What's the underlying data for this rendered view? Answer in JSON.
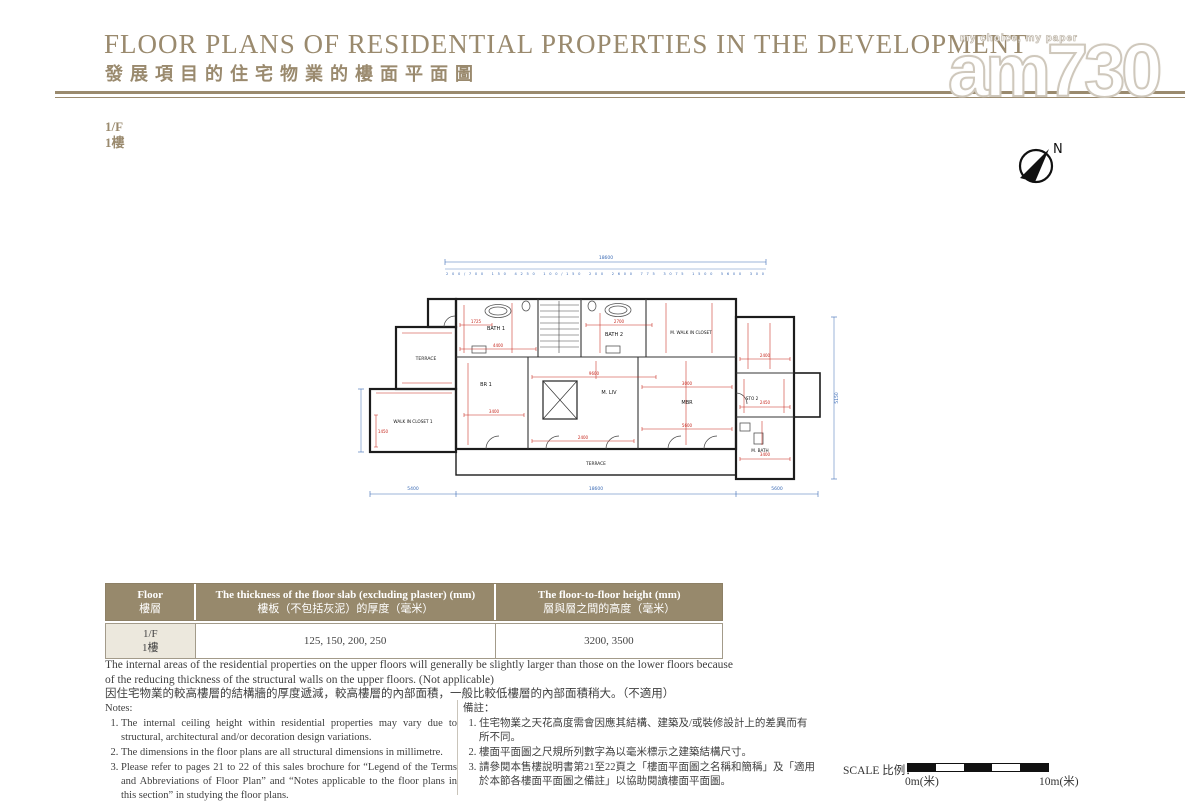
{
  "header": {
    "title_en": "FLOOR PLANS OF RESIDENTIAL PROPERTIES IN THE DEVELOPMENT",
    "title_zh": "發展項目的住宅物業的樓面平面圖"
  },
  "watermark": {
    "tagline": "my choice, my paper",
    "brand": "am730"
  },
  "floor_label": {
    "en": "1/F",
    "zh": "1樓"
  },
  "compass": {
    "n": "N"
  },
  "plan": {
    "rooms": [
      "BATH 1",
      "BATH 2",
      "M. WALK IN CLOSET",
      "TERRACE",
      "WALK IN CLOSET 1",
      "BR 1",
      "M. LIV",
      "MBR",
      "STO 2",
      "M. BATH",
      "TERRACE"
    ],
    "dims_blue": {
      "top_total": "18600",
      "top_subs": "200/700 150 4250 100/150 200 2600 775 3075 1500 5600 300",
      "bottom_left": "5400",
      "bottom_center": "18600",
      "bottom_right": "5600",
      "right_side": "5150"
    },
    "dims_red": [
      "4400",
      "9600",
      "3400",
      "3000",
      "2400",
      "2450",
      "5600",
      "2400",
      "1450",
      "3400",
      "1725",
      "2700"
    ]
  },
  "table": {
    "headers": {
      "floor_en": "Floor",
      "floor_zh": "樓層",
      "thickness_en": "The thickness of the floor slab (excluding plaster) (mm)",
      "thickness_zh": "樓板（不包括灰泥）的厚度（毫米）",
      "height_en": "The floor-to-floor height (mm)",
      "height_zh": "層與層之間的高度（毫米）"
    },
    "row": {
      "floor_en": "1/F",
      "floor_zh": "1樓",
      "thickness": "125, 150, 200, 250",
      "height": "3200, 3500"
    }
  },
  "area_note": {
    "en": "The internal areas of the residential properties on the upper floors will generally be slightly larger than those on the lower floors because of the reducing thickness of the structural walls on the upper floors. (Not applicable)",
    "zh": "因住宅物業的較高樓層的結構牆的厚度遞減，較高樓層的內部面積，一般比較低樓層的內部面積稍大。（不適用）"
  },
  "notes_en": {
    "title": "Notes:",
    "items": [
      "The internal ceiling height within residential properties may vary due to structural, architectural and/or decoration design variations.",
      "The dimensions in the floor plans are all structural dimensions in millimetre.",
      "Please refer to pages 21 to 22 of this sales brochure for “Legend of the Terms and Abbreviations of Floor Plan” and “Notes applicable to the floor plans in this section” in studying the floor plans."
    ]
  },
  "notes_zh": {
    "title": "備註：",
    "items": [
      "住宅物業之天花高度需會因應其結構、建築及/或裝修設計上的差異而有所不同。",
      "樓面平面圖之尺規所列數字為以毫米標示之建築結構尺寸。",
      "請參閱本售樓說明書第21至22頁之「樓面平面圖之名稱和簡稱」及「適用於本節各樓面平面圖之備註」以協助閱讀樓面平面圖。"
    ]
  },
  "scale": {
    "label": "SCALE 比例：",
    "zero": "0m(米)",
    "ten": "10m(米)"
  }
}
